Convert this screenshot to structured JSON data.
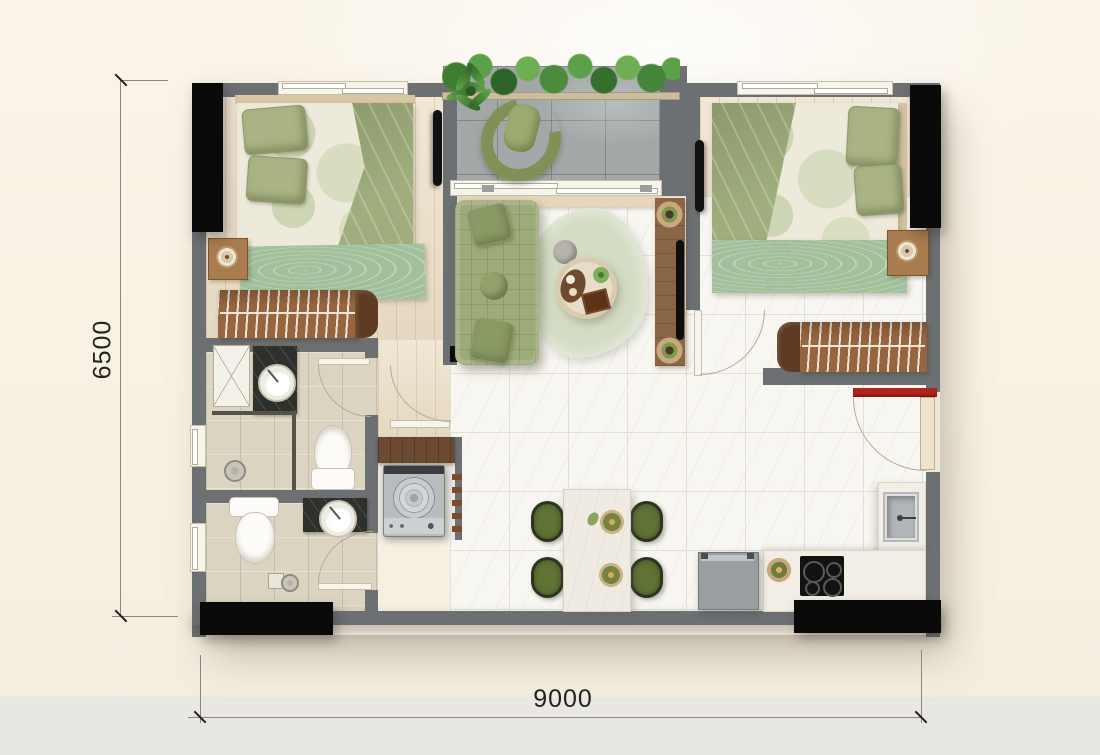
{
  "title": "two-bedroom apartment floor plan",
  "dimensions": {
    "width": {
      "label": "9000"
    },
    "height": {
      "label": "6500"
    }
  },
  "palette": {
    "background": "#f8f1e3",
    "wall_gray": "#6c7072",
    "column_black": "#0a0a0a",
    "floor_wood": "#ecdfc6",
    "floor_marble": "#f8f6f1",
    "floor_bath_tile": "#dbd4c1",
    "floor_balcony_tile": "#a3a7a8",
    "furniture_green": "#9cab77",
    "chair_green": "#5f7434",
    "wood_brown": "#96653f",
    "entry_accent_red": "#b2221f"
  },
  "rooms": [
    {
      "name": "bedroom-1",
      "furniture": [
        "double-bed",
        "pillows",
        "green-throw-blanket",
        "bed-runner",
        "nightstand-with-lamp",
        "wardrobe-with-hangers",
        "wall-tv"
      ]
    },
    {
      "name": "bathroom-1",
      "furniture": [
        "round-washbasin-on-dark-counter",
        "toilet",
        "shower-head",
        "technical-shaft",
        "swing-door"
      ]
    },
    {
      "name": "bathroom-2",
      "furniture": [
        "round-washbasin-on-dark-counter",
        "toilet",
        "shower-drain",
        "swing-door"
      ]
    },
    {
      "name": "utility-niche",
      "furniture": [
        "washing-machine",
        "dark-wood-counter",
        "towel-rack"
      ]
    },
    {
      "name": "balcony",
      "furniture": [
        "planter-hedge",
        "potted-plant",
        "curved-lounge-chair",
        "sliding-glass-door"
      ]
    },
    {
      "name": "living-room",
      "furniture": [
        "tufted-sofa",
        "organic-rug",
        "round-coffee-table",
        "tv-console-with-pots",
        "gray-stool"
      ]
    },
    {
      "name": "dining-area",
      "furniture": [
        "marble-dining-table",
        "four-green-chairs",
        "two-place-settings"
      ]
    },
    {
      "name": "kitchen",
      "furniture": [
        "l-shaped-counter",
        "sink",
        "induction-hob",
        "fridge",
        "serving-bowl"
      ]
    },
    {
      "name": "bedroom-2",
      "furniture": [
        "double-bed",
        "pillows",
        "green-throw-blanket",
        "bed-runner",
        "nightstand-with-lamp",
        "wardrobe-with-hangers",
        "wall-tv",
        "swing-door"
      ]
    },
    {
      "name": "entry",
      "furniture": [
        "entrance-door",
        "red-lintel"
      ]
    }
  ]
}
